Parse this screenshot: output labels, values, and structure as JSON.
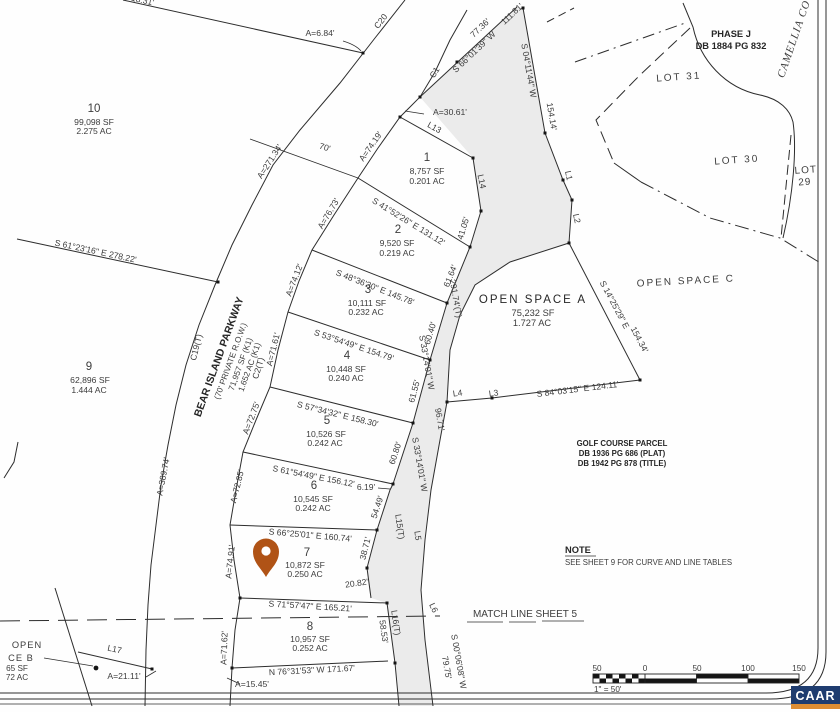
{
  "map": {
    "lots": [
      {
        "id": "1",
        "sf": "8,757 SF",
        "ac": "0.201 AC"
      },
      {
        "id": "2",
        "sf": "9,520 SF",
        "ac": "0.219 AC"
      },
      {
        "id": "3",
        "sf": "10,111 SF",
        "ac": "0.232 AC"
      },
      {
        "id": "4",
        "sf": "10,448 SF",
        "ac": "0.240 AC"
      },
      {
        "id": "5",
        "sf": "10,526 SF",
        "ac": "0.242 AC"
      },
      {
        "id": "6",
        "sf": "10,545 SF",
        "ac": "0.242 AC"
      },
      {
        "id": "7",
        "sf": "10,872 SF",
        "ac": "0.250 AC"
      },
      {
        "id": "8",
        "sf": "10,957 SF",
        "ac": "0.252 AC"
      },
      {
        "id": "9",
        "sf": "62,896 SF",
        "ac": "1.444 AC"
      },
      {
        "id": "10",
        "sf": "99,098 SF",
        "ac": "2.275 AC"
      }
    ],
    "road": {
      "name": "BEAR ISLAND PARKWAY",
      "row": "(70' PRIVATE R.O.W.)",
      "sf": "71,957 SF (K1)",
      "ac": "1.652 AC (K1)",
      "camellia": "CAMELLIA CO"
    },
    "open_spaces": {
      "a_title": "OPEN SPACE A",
      "a_sf": "75,232 SF",
      "a_ac": "1.727 AC",
      "c_title": "OPEN SPACE C",
      "b_l1": "OPEN",
      "b_l2": "CE B",
      "b_sf": "65 SF",
      "b_ac": "72 AC"
    },
    "parcels": {
      "phase_l1": "PHASE J",
      "phase_l2": "DB 1884 PG 832",
      "lot31": "LOT 31",
      "lot30": "LOT 30",
      "lot29_l1": "LOT",
      "lot29_l2": "29",
      "golf_l1": "GOLF COURSE PARCEL",
      "golf_l2": "DB 1936 PG 686 (PLAT)",
      "golf_l3": "DB 1942 PG 878 (TITLE)"
    },
    "note": {
      "title": "NOTE",
      "body": "SEE SHEET 9 FOR CURVE AND LINE TABLES"
    },
    "match_line": "MATCH LINE SHEET 5",
    "bearings": {
      "d12": "S 41°52'26\" E  131.12'",
      "d23": "S 48°36'30\" E  145.78'",
      "d34": "S 53°54'49\" E  154.79'",
      "d45": "S 57°34'32\" E  158.30'",
      "d56": "S 61°54'49\" E  156.12'",
      "d67": "S 66°25'01\" E  160.74'",
      "d78": "S 71°57'47\" E  165.21'",
      "lot8_south": "N 76°31'53\" W  171.67'",
      "lot9_north": "S 61°23'16\" E  278.22'",
      "top_dist": "77.36'",
      "top_bearing": "S 66°01'39\" W",
      "top_dist2": "111.81'",
      "east_bearing": "S 04°11'44\" W",
      "east_dist": "154.14'",
      "osa_east_bearing": "S 14°25'29\" E",
      "osa_east_dist": "154.34'",
      "osa_south": "S 84°03'15\" E  124.11'",
      "strip_dist_t": "291.74'(T)",
      "strip_bearing": "S 33°14'01\" W",
      "strip_dist2": "96.71'",
      "strip_bearing2": "S 33°14'01\" W",
      "south_bearing": "S 00°06'08\" W",
      "south_dist": "79.75'",
      "frag": "18.31'"
    },
    "arcs": {
      "c20": "C20",
      "c1": "C1",
      "c19": "C19(T)",
      "c2": "C2(T)",
      "a1": "A=6.84'",
      "a2": "A=30.61'",
      "a3": "A=271.34'",
      "a4": "A=389.74'",
      "a_lot1": "A=74.19'",
      "a_lot2": "A=76.73'",
      "a_lot3": "A=74.12'",
      "a_lot4": "A=71.61'",
      "a_lot5": "A=72.75'",
      "a_lot6": "A=72.85'",
      "a_lot7": "A=74.91'",
      "a_lot8": "A=71.62'",
      "a_osb1": "A=15.45'",
      "a_osb2": "A=21.11'",
      "road_width": "70'"
    },
    "segs": {
      "s4105": "41.05'",
      "s6164": "61.64'",
      "s6040": "60.40'",
      "s6155": "61.55'",
      "s6080": "60.80'",
      "s619": "6.19'",
      "s5449": "54.49'",
      "s3871": "38.71'",
      "s2082": "20.82'",
      "s5853": "58.53'"
    },
    "lines": {
      "l1": "L1",
      "l2": "L2",
      "l3": "L3",
      "l4": "L4",
      "l5": "L5",
      "l6": "L6",
      "l13": "L13",
      "l14": "L14",
      "l15": "L15(T)",
      "l16": "L16(T)",
      "l17": "L17"
    },
    "scale": {
      "t1": "50",
      "t2": "0",
      "t3": "50",
      "t4": "100",
      "t5": "150",
      "ratio": "1\" = 50'"
    },
    "branding": {
      "caar": "CAAR",
      "navy": "#1e3c6f",
      "orange": "#dd8d33"
    },
    "pin_color": "#b05316"
  }
}
